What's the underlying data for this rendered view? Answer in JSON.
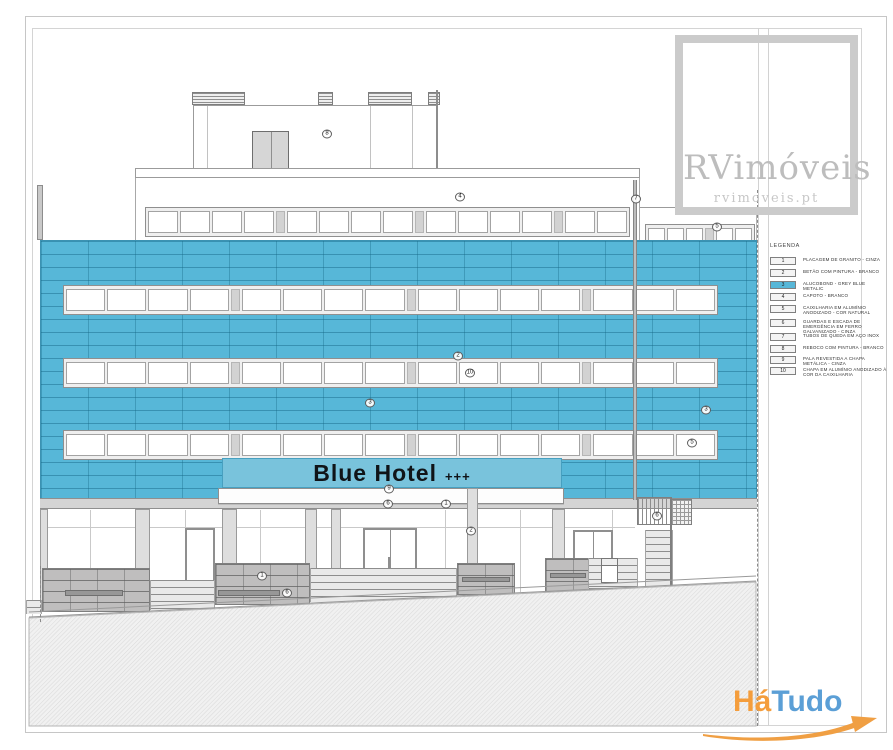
{
  "sign": {
    "name": "Blue Hotel",
    "stars": "+++"
  },
  "watermark": {
    "name": "RVimóveis",
    "site": "rvimoveis.pt"
  },
  "logo": {
    "part1": "Há",
    "part2": "Tudo"
  },
  "legend": {
    "title": "LEGENDA",
    "items": [
      {
        "num": "1",
        "label": "PLACAGEM DE GRANITO - CINZA",
        "highlight": false
      },
      {
        "num": "2",
        "label": "BETÃO COM PINTURA - BRANCO",
        "highlight": false
      },
      {
        "num": "3",
        "label": "ALUCOBOND - GREY BLUE METALIC",
        "highlight": true
      },
      {
        "num": "4",
        "label": "CAPOTO - BRANCO",
        "highlight": false
      },
      {
        "num": "5",
        "label": "CAIXILHARIA EM ALUMÍNIO ANODIZADO - COR NATURAL",
        "highlight": false
      },
      {
        "num": "6",
        "label": "GUARDAS E ESCADA DE EMERGÊNCIA EM FERRO GALVANIZADO - CINZA",
        "highlight": false
      },
      {
        "num": "7",
        "label": "TUBOS DE QUEDA EM AÇO INOX",
        "highlight": false
      },
      {
        "num": "8",
        "label": "REBOCO COM PINTURA - BRANCO",
        "highlight": false
      },
      {
        "num": "9",
        "label": "PALA REVESTIDA A CHAPA METÁLICA - CINZA",
        "highlight": false
      },
      {
        "num": "10",
        "label": "CHAPA EM ALUMÍNIO ANODIZADO À COR DA CAIXILHARIA",
        "highlight": false
      }
    ]
  },
  "markers": [
    {
      "value": "8",
      "x": 327,
      "y": 134
    },
    {
      "value": "4",
      "x": 460,
      "y": 197
    },
    {
      "value": "5",
      "x": 717,
      "y": 227
    },
    {
      "value": "7",
      "x": 636,
      "y": 199
    },
    {
      "value": "2",
      "x": 458,
      "y": 356
    },
    {
      "value": "10",
      "x": 470,
      "y": 373
    },
    {
      "value": "3",
      "x": 370,
      "y": 403
    },
    {
      "value": "3",
      "x": 706,
      "y": 410
    },
    {
      "value": "5",
      "x": 692,
      "y": 443
    },
    {
      "value": "9",
      "x": 389,
      "y": 489
    },
    {
      "value": "6",
      "x": 388,
      "y": 504
    },
    {
      "value": "1",
      "x": 446,
      "y": 504
    },
    {
      "value": "2",
      "x": 471,
      "y": 531
    },
    {
      "value": "1",
      "x": 262,
      "y": 576
    },
    {
      "value": "6",
      "x": 287,
      "y": 593
    },
    {
      "value": "6",
      "x": 657,
      "y": 516
    }
  ],
  "colors": {
    "facade_blue": "#57B7D8",
    "facade_joint": "#2F8FB3",
    "legend_highlight": "#57B7D8",
    "logo_orange": "#F49D3C",
    "logo_blue": "#5B9FD6",
    "watermark_gray": "#BDBDBD"
  }
}
